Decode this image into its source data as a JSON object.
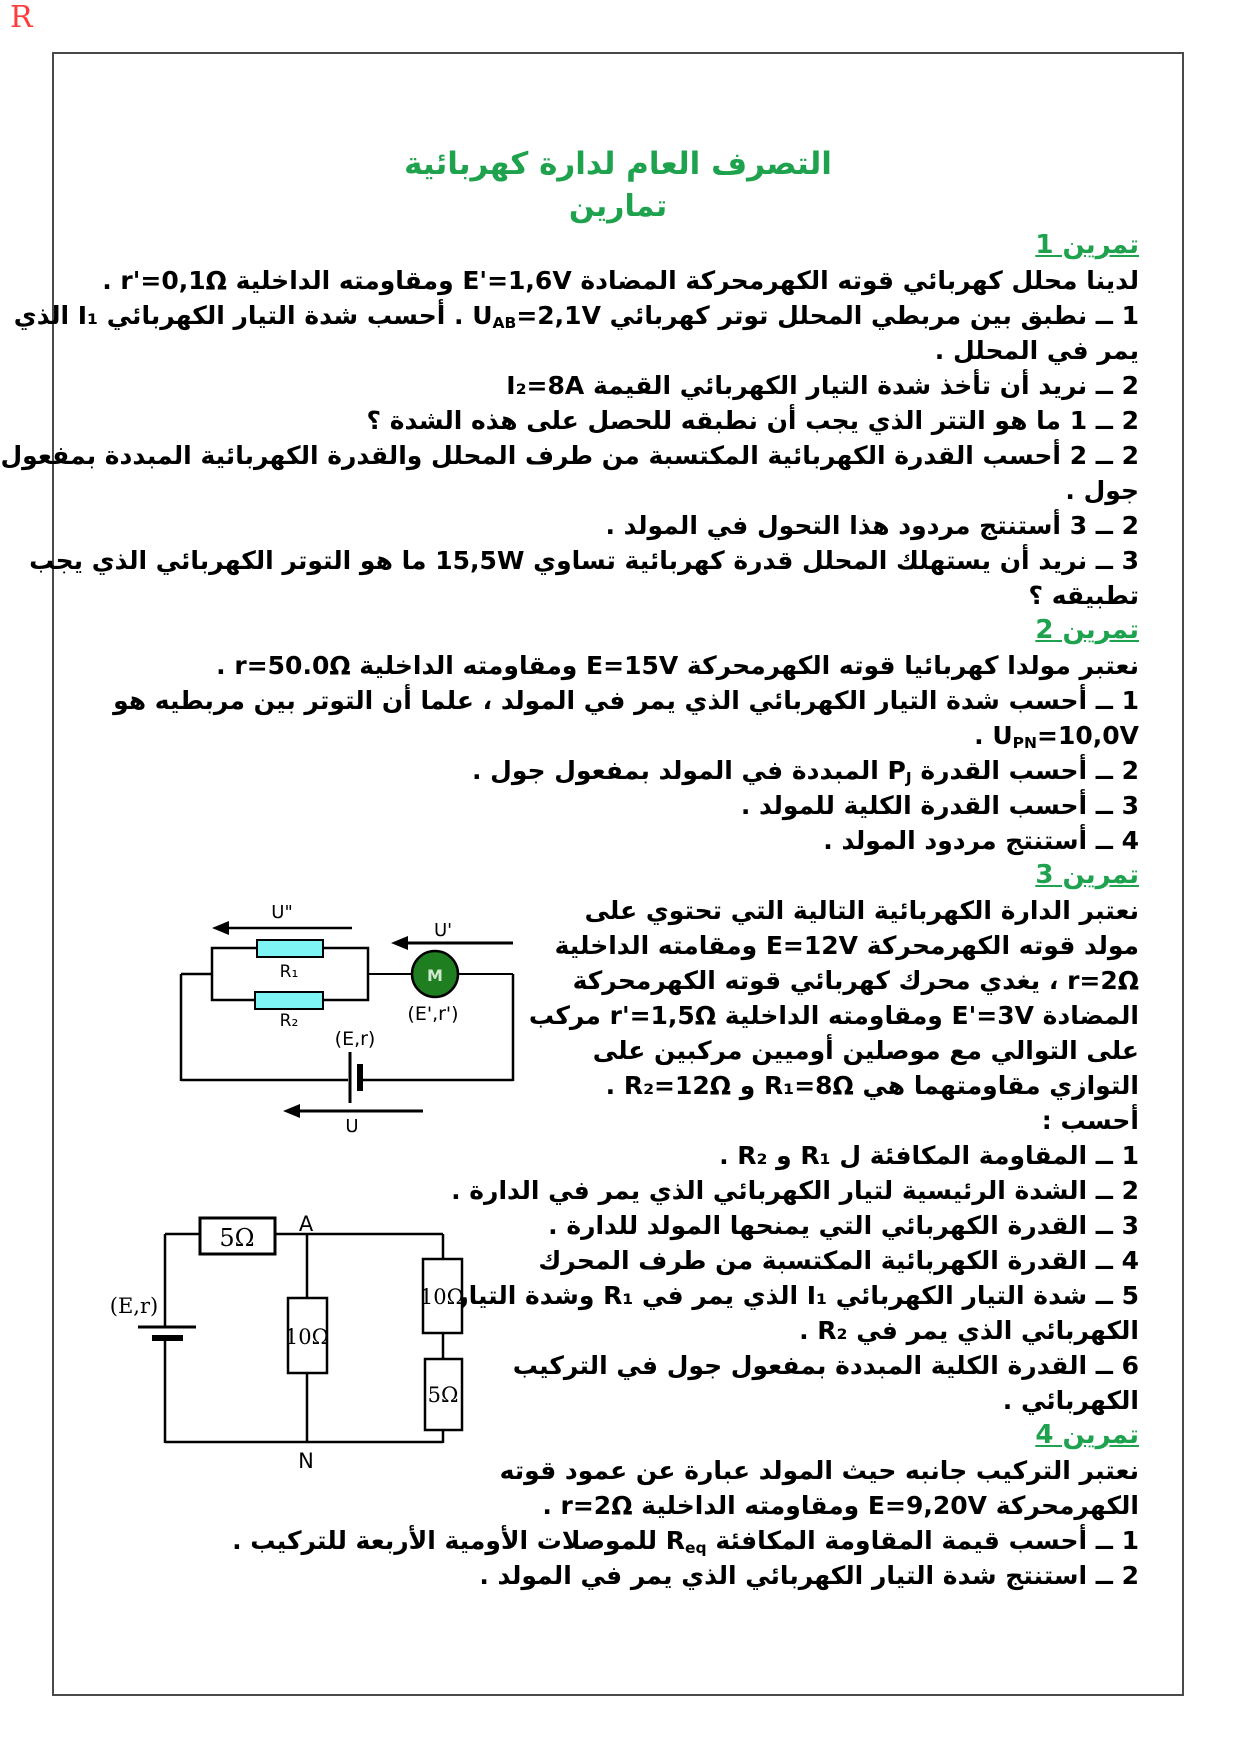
{
  "page": {
    "corner_mark": "R",
    "title": "التصرف العام لدارة كهربائية",
    "subtitle": "تمارين"
  },
  "colors": {
    "heading_green": "#1ea24e",
    "resistor_cyan": "#7ef4f4",
    "motor_green": "#1f7e1f",
    "corner_red": "#ff3b3b",
    "border_gray": "#4a4a4a"
  },
  "exercises": [
    {
      "heading": "تمرين 1",
      "lines": [
        "لدينا محلل كهربائي قوته الكهرمحركة المضادة E'=1,6V ومقاومته الداخلية r'=0,1Ω .",
        [
          {
            "t": "1 ــ نطبق بين مربطي المحلل توتر كهربائي U"
          },
          {
            "t": "AB",
            "sub": true
          },
          {
            "t": "=2,1V . أحسب شدة التيار الكهربائي I₁ الذي"
          }
        ],
        "يمر في المحلل .",
        "2 ــ نريد أن تأخذ شدة التيار الكهربائي القيمة I₂=8A",
        "2 ــ 1 ما هو التتر الذي يجب أن نطبقه للحصل على هذه الشدة ؟",
        "2 ــ 2 أحسب القدرة الكهربائية المكتسبة من طرف المحلل والقدرة الكهربائية المبددة بمفعول",
        "جول .",
        "2 ــ 3 أستنتج مردود هذا التحول في المولد .",
        "3 ــ نريد أن يستهلك المحلل قدرة كهربائية تساوي 15,5W ما هو التوتر الكهربائي الذي يجب",
        "تطبيقه ؟"
      ]
    },
    {
      "heading": "تمرين 2",
      "lines": [
        "نعتبر مولدا كهربائيا قوته الكهرمحركة E=15V ومقاومته الداخلية r=50.0Ω .",
        "1 ــ أحسب شدة التيار الكهربائي الذي يمر في المولد ، علما أن التوتر بين مربطيه هو",
        [
          {
            "t": "U"
          },
          {
            "t": "PN",
            "sub": true
          },
          {
            "t": "=10,0V ."
          }
        ],
        [
          {
            "t": "2 ــ أحسب القدرة P"
          },
          {
            "t": "J",
            "sub": true
          },
          {
            "t": " المبددة في المولد بمفعول جول ."
          }
        ],
        "3 ــ أحسب القدرة الكلية للمولد .",
        "4 ــ أستنتج مردود المولد ."
      ]
    },
    {
      "heading": "تمرين 3",
      "lines": [
        "نعتبر الدارة الكهربائية التالية التي تحتوي على",
        "مولد  قوته الكهرمحركة E=12V ومقامته الداخلية",
        "r=2Ω ، يغدي محرك كهربائي قوته الكهرمحركة",
        "المضادة E'=3V ومقاومته الداخلية r'=1,5Ω مركب",
        "على التوالي مع موصلين أوميين مركبين على",
        "التوازي مقاومتهما هي R₁=8Ω و R₂=12Ω .",
        "أحسب :",
        "1 ــ المقاومة المكافئة ل R₁ و R₂ .",
        "2 ــ الشدة الرئيسية لتيار الكهربائي الذي يمر في الدارة .",
        "3 ــ القدرة الكهربائي التي يمنحها المولد للدارة .",
        "4 ــ القدرة الكهربائية المكتسبة من طرف المحرك",
        "5 ــ شدة التيار الكهربائي I₁ الذي يمر في R₁ وشدة التيار",
        "الكهربائي الذي يمر في R₂ .",
        "6 ــ القدرة الكلية المبددة بمفعول جول في التركيب",
        "الكهربائي ."
      ]
    },
    {
      "heading": "تمرين 4",
      "lines": [
        "نعتبر التركيب جانبه حيث المولد عبارة عن عمود قوته",
        "الكهرمحركة E=9,20V ومقاومته الداخلية r=2Ω .",
        [
          {
            "t": "1 ــ أحسب قيمة المقاومة المكافئة R"
          },
          {
            "t": "eq",
            "sub": true
          },
          {
            "t": " للموصلات الأومية الأربعة للتركيب ."
          }
        ],
        "2 ــ استنتج شدة التيار الكهربائي الذي يمر في المولد ."
      ]
    }
  ],
  "circuit1": {
    "labels": {
      "u_second": "U\"",
      "u_prime": "U'",
      "u": "U",
      "r1": "R₁",
      "r2": "R₂",
      "motor": "M",
      "motor_params": "(E',r')",
      "battery_params": "(E,r)"
    }
  },
  "circuit2": {
    "labels": {
      "series_resistor": "5Ω",
      "node_a": "A",
      "middle_resistor": "10Ω",
      "branch_resistor_top": "10Ω",
      "branch_resistor_bottom": "5Ω",
      "node_n": "N",
      "battery_params": "(E,r)"
    }
  }
}
